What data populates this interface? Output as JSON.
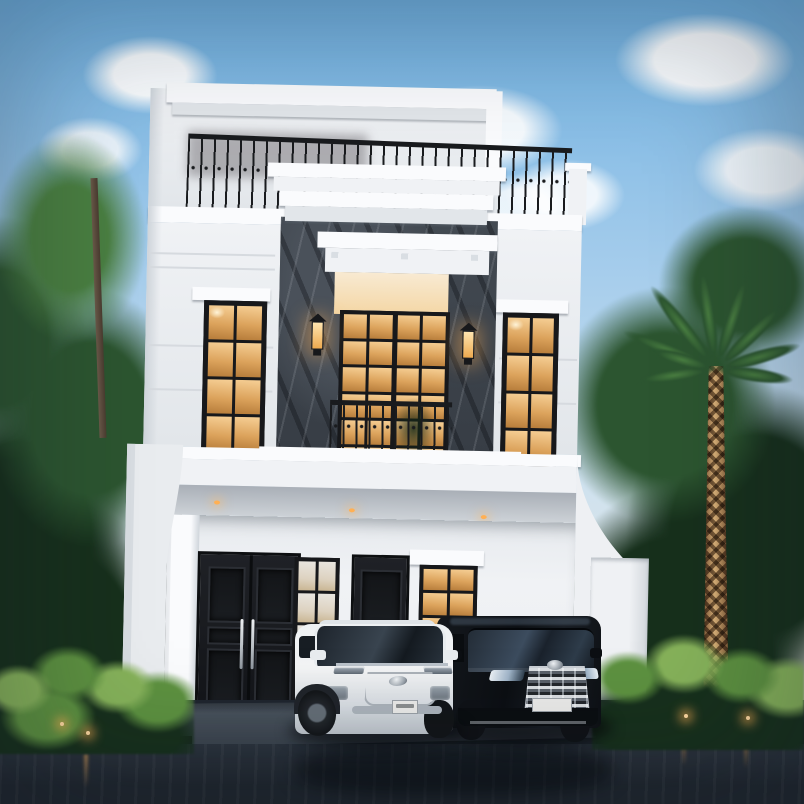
{
  "scene": {
    "type": "3D architectural exterior rendering",
    "description": "Two-story modern classic white house at dusk: rooftop terrace with black wrought-iron railing, central balcony with dark marble cladding and glowing French doors, lantern wall sconces, tall warm-lit windows, black panel entry doors, a white SUV and a black luxury van parked on a dark wet driveway, framed by tropical trees, a palm and fern beds with garden lights",
    "time_of_day": "dusk",
    "house": {
      "style": "modern classic",
      "floors": 2,
      "features": [
        "rooftop terrace with wrought-iron balustrade",
        "stepped white cornices and moldings",
        "dark marble accent cladding around balcony",
        "French balcony doors with warm interior glow",
        "two lantern wall sconces",
        "recessed soffit downlights",
        "black double entry door with steel pull handles",
        "secondary black door and warm-lit ground window",
        "curved side boundary walls",
        "white gate pillar"
      ]
    },
    "vehicles": [
      {
        "kind": "white SUV",
        "position": "front-left",
        "facing": "front three-quarter",
        "details": [
          "dark mesh grille",
          "chrome emblem",
          "white license plate"
        ]
      },
      {
        "kind": "black luxury MPV van",
        "position": "front-right",
        "facing": "front",
        "details": [
          "large chrome grille",
          "slim LED headlights",
          "white license plate"
        ]
      }
    ],
    "landscape": [
      "dense green trees on left and right",
      "palm tree with diamond-patterned trunk on right",
      "fern shrub beds flanking the driveway",
      "four warm garden path lights"
    ],
    "ground": "dark wet reflective driveway with carport apron",
    "lighting": [
      "warm window glow",
      "balcony sconces",
      "three soffit downlights",
      "garden lights",
      "soft dusk sky"
    ]
  },
  "colors": {
    "sky_top": "#6fb0e0",
    "sky_mid": "#a6cdec",
    "sky_low": "#cfe2ef",
    "haze": "#e7e6de",
    "cloud": "#ffffff",
    "foliage_dark": "#17301c",
    "foliage_mid": "#2c5530",
    "foliage_light": "#4a7f41",
    "fern": "#5d9140",
    "fern_light": "#86b25a",
    "palm_trunk": "#d9b078",
    "palm_trunk_dark": "#7a5532",
    "facade_bright": "#fafbfd",
    "facade": "#f0f2f5",
    "facade_shade": "#e2e6ea",
    "facade_deep": "#cfd5db",
    "marble": "#3d434b",
    "frame": "#17181b",
    "glass_hi": "#f6cf95",
    "glass_mid": "#dca35c",
    "glass_lo": "#b67c3a",
    "glow": "#ffe2b0",
    "railing": "#191b1e",
    "soffit_dark": "#a9afb7",
    "soffit_light": "#cdd2d7",
    "carport": "#4d5660",
    "carport_dark": "#39424c",
    "driveway": "#2b333d",
    "driveway_deep": "#1f262e",
    "curb": "#181d23",
    "suv_body": "#f3f4f5",
    "suv_shade": "#bcc3ca",
    "van_body": "#0d1014",
    "van_gloss": "#3c4c5e",
    "chrome": "#c9ced4",
    "warm": "#ffb054",
    "plate": "#eaeae8"
  }
}
